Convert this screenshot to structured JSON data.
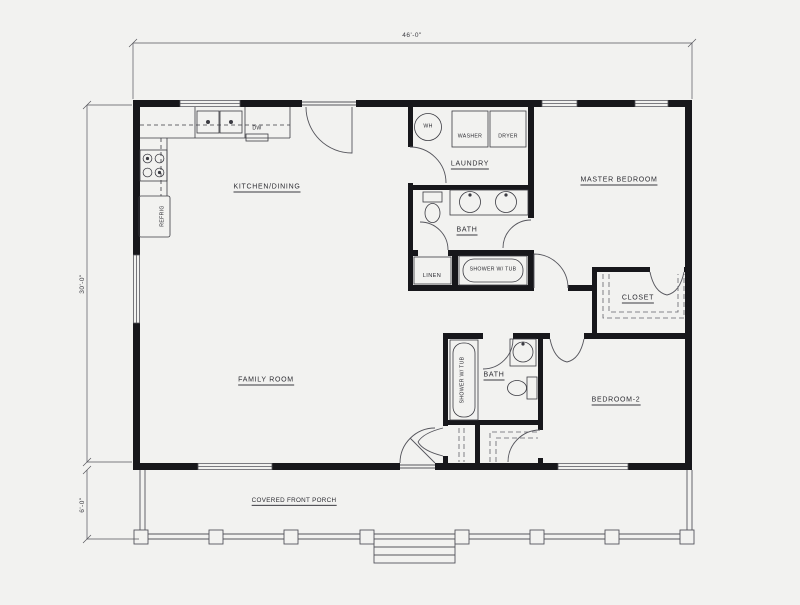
{
  "drawing": {
    "type": "residential floor plan"
  },
  "dimensions": {
    "overall_width": "46'-0\"",
    "overall_depth": "30'-0\"",
    "porch_depth": "6'-0\""
  },
  "rooms": {
    "kitchen_dining": "KITCHEN/DINING",
    "family_room": "FAMILY ROOM",
    "laundry": "LAUNDRY",
    "master_bedroom": "MASTER BEDROOM",
    "master_bath": "BATH",
    "linen_closet": "LINEN",
    "master_closet": "CLOSET",
    "bath_2": "BATH",
    "bedroom_2": "BEDROOM-2",
    "covered_front_porch": "COVERED FRONT PORCH"
  },
  "fixtures": {
    "water_heater": "WH",
    "washer": "WASHER",
    "dryer": "DRYER",
    "dishwasher": "DW",
    "refrigerator": "REFRIG",
    "master_shower_tub": "SHOWER W/ TUB",
    "bath2_shower_tub": "SHOWER W/ TUB"
  },
  "colors": {
    "paper": "#f2f2f0",
    "wall": "#17171b",
    "line": "#55555c",
    "text": "#2b2b31"
  }
}
